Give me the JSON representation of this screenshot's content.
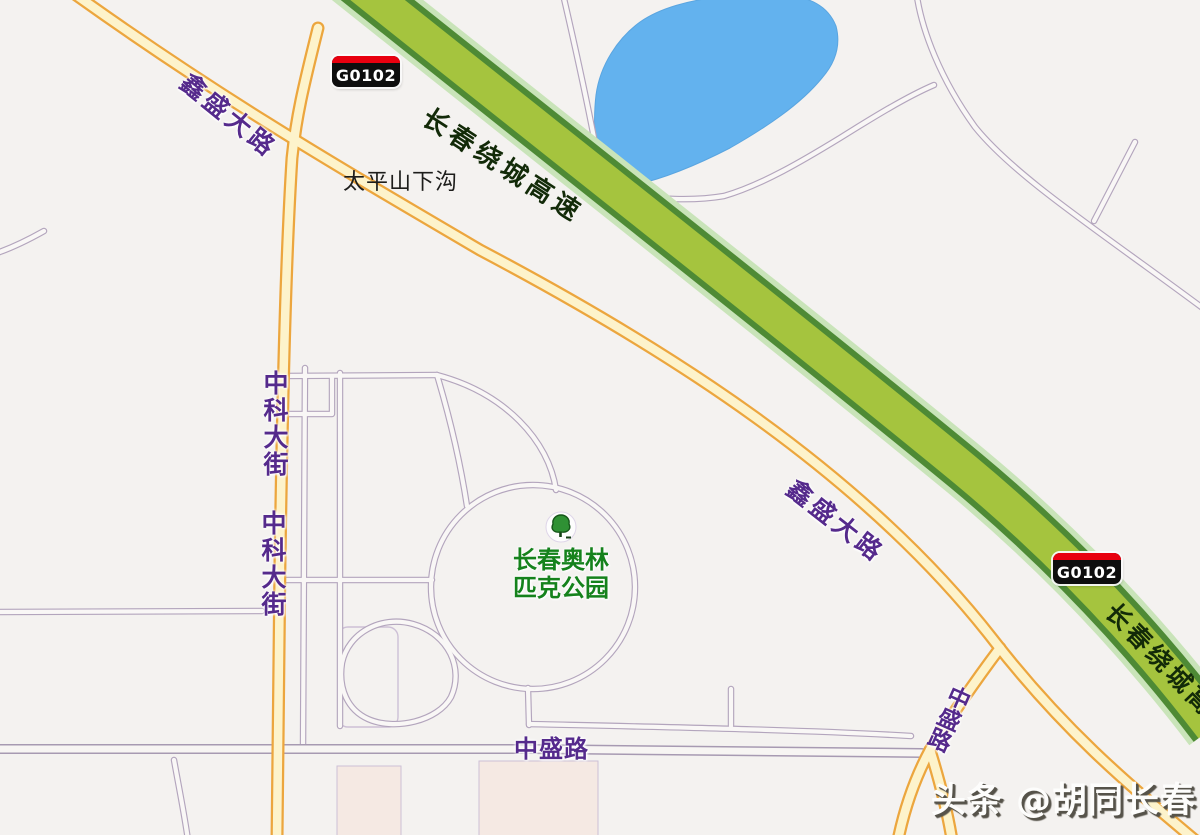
{
  "map": {
    "highway": {
      "code": "G0102",
      "name": "长春绕城高速"
    },
    "road_labels": {
      "xinsheng_dalu": "鑫盛大路",
      "zhongke_dajie": "中科大街",
      "zhongsheng_lu": "中盛路"
    },
    "place_labels": {
      "taipingshan_xiagou": "太平山下沟",
      "park_line1": "长春奥林",
      "park_line2": "匹克公园"
    },
    "watermark": "头条 @胡同长春"
  },
  "colors": {
    "bg": "#f4f2f0",
    "highway-fill": "#a5c43e",
    "highway-casing": "#4e8a35",
    "highway-halo": "#c9e4b9",
    "road-casing": "#eca63e",
    "road-fill": "#fdf3cb",
    "minor-casing": "#b3a5bd",
    "minor-fill": "#f9f7f6",
    "street-casing": "#a79ab2",
    "street-fill": "#f7f5f3",
    "water": "#63b2ee",
    "water-edge": "#5aa5e0",
    "label-purple": "#552a8c",
    "label-black": "#1d1d1b",
    "highway-label": "#122a08",
    "park-green": "#15821c",
    "badge-bg": "#0e0e0e",
    "badge-red": "#e8000f",
    "badge-text": "#ffffff",
    "watermark-fill": "#fdfdfc",
    "watermark-shadow": "#56534a",
    "block-fill": "#f5e9e3",
    "block-outline": "#cdc0d6"
  }
}
